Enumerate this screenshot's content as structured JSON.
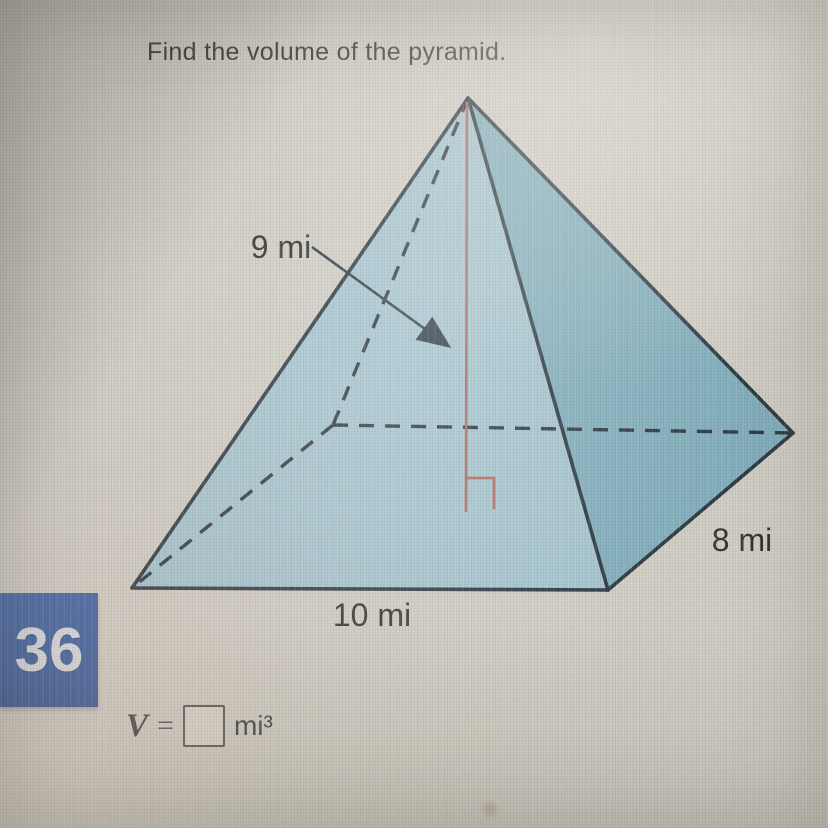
{
  "header": {
    "title": "Find the volume of the pyramid."
  },
  "question": {
    "number": "36"
  },
  "diagram": {
    "height_label": "9 mi",
    "depth_label": "8 mi",
    "width_label": "10 mi"
  },
  "answer": {
    "variable": "V",
    "equals": "=",
    "value": "",
    "unit": "mi³"
  },
  "colors": {
    "face_front": "#a4c4cf",
    "face_right": "#81aebc",
    "edge": "#2a3740",
    "height_line": "#b06a5e",
    "label_text": "#33302b",
    "badge_bg": "#35589b",
    "badge_text": "#d9dde2"
  }
}
